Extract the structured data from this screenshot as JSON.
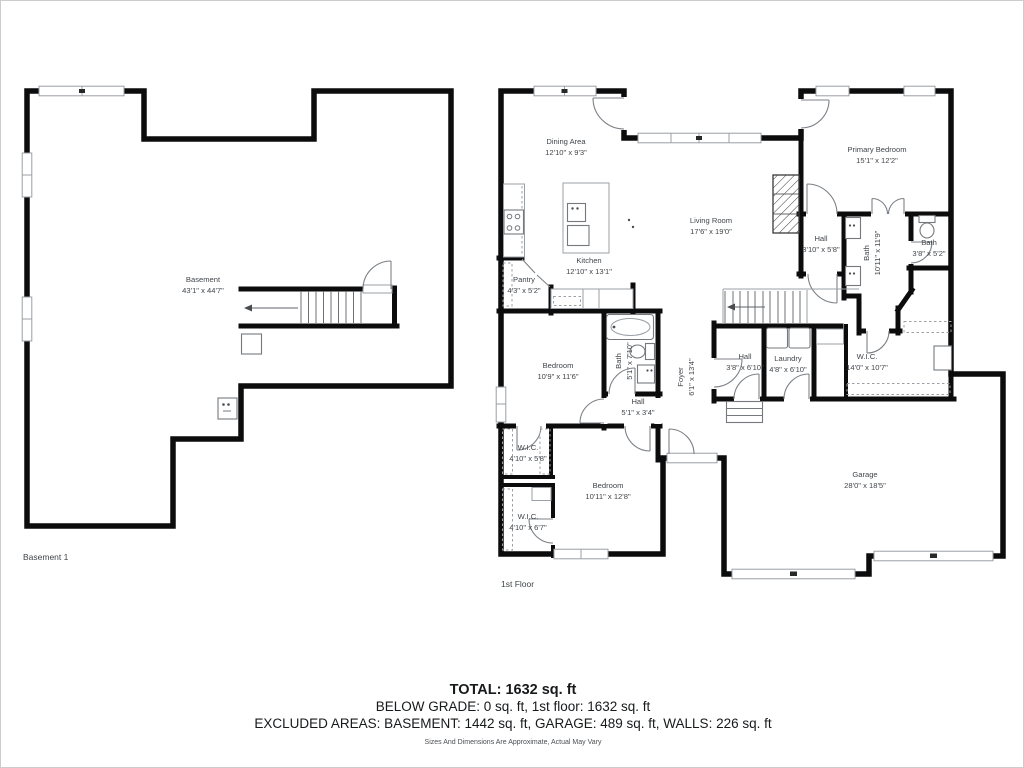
{
  "page": {
    "background": "#ffffff",
    "wall_color": "#0c0c0c",
    "label_color": "#41464b"
  },
  "floors": [
    {
      "id": "basement",
      "caption": "Basement 1",
      "rooms": [
        {
          "name": "Basement",
          "dims": "43'1\" x 44'7\"",
          "x": 202,
          "y": 281,
          "rotate": 0
        }
      ]
    },
    {
      "id": "first",
      "caption": "1st Floor",
      "rooms": [
        {
          "name": "Dining Area",
          "dims": "12'10\" x 9'3\"",
          "x": 565,
          "y": 143,
          "rotate": 0
        },
        {
          "name": "Kitchen",
          "dims": "12'10\" x 13'1\"",
          "x": 588,
          "y": 262,
          "rotate": 0
        },
        {
          "name": "Pantry",
          "dims": "4'3\" x 5'2\"",
          "x": 523,
          "y": 281,
          "rotate": 0
        },
        {
          "name": "Living Room",
          "dims": "17'6\" x 19'0\"",
          "x": 710,
          "y": 222,
          "rotate": 0
        },
        {
          "name": "Primary Bedroom",
          "dims": "15'1\" x 12'2\"",
          "x": 876,
          "y": 151,
          "rotate": 0
        },
        {
          "name": "Hall",
          "dims": "3'10\" x 5'8\"",
          "x": 820,
          "y": 240,
          "rotate": 0
        },
        {
          "name": "Bath",
          "dims": "10'11\" x 11'9\"",
          "x": 870,
          "y": 252,
          "rotate": -90
        },
        {
          "name": "Bath",
          "dims": "3'8\" x 5'2\"",
          "x": 928,
          "y": 244,
          "rotate": 0
        },
        {
          "name": "Foyer",
          "dims": "6'1\" x 13'4\"",
          "x": 684,
          "y": 376,
          "rotate": -90
        },
        {
          "name": "Bath",
          "dims": "5'1\" x 7'10\"",
          "x": 622,
          "y": 360,
          "rotate": -90
        },
        {
          "name": "Hall",
          "dims": "5'1\" x 3'4\"",
          "x": 637,
          "y": 403,
          "rotate": 0
        },
        {
          "name": "Bedroom",
          "dims": "10'9\" x 11'6\"",
          "x": 557,
          "y": 367,
          "rotate": 0
        },
        {
          "name": "W.I.C.",
          "dims": "4'10\" x 5'8\"",
          "x": 527,
          "y": 449,
          "rotate": 0
        },
        {
          "name": "W.I.C.",
          "dims": "4'10\" x 6'7\"",
          "x": 527,
          "y": 518,
          "rotate": 0
        },
        {
          "name": "Bedroom",
          "dims": "10'11\" x 12'8\"",
          "x": 607,
          "y": 487,
          "rotate": 0
        },
        {
          "name": "Hall",
          "dims": "3'8\" x 6'10\"",
          "x": 744,
          "y": 358,
          "rotate": 0
        },
        {
          "name": "Laundry",
          "dims": "4'8\" x 6'10\"",
          "x": 787,
          "y": 360,
          "rotate": 0
        },
        {
          "name": "W.I.C.",
          "dims": "14'0\" x 10'7\"",
          "x": 866,
          "y": 358,
          "rotate": 0
        },
        {
          "name": "Garage",
          "dims": "28'0\" x 18'5\"",
          "x": 864,
          "y": 476,
          "rotate": 0
        }
      ]
    }
  ],
  "footer": {
    "total": "TOTAL: 1632 sq. ft",
    "below_grade": "BELOW GRADE: 0 sq. ft, 1st floor: 1632 sq. ft",
    "excluded": "EXCLUDED AREAS: BASEMENT: 1442 sq. ft, GARAGE: 489 sq. ft, WALLS: 226 sq. ft",
    "disclaimer": "Sizes And Dimensions Are Approximate, Actual May Vary"
  }
}
